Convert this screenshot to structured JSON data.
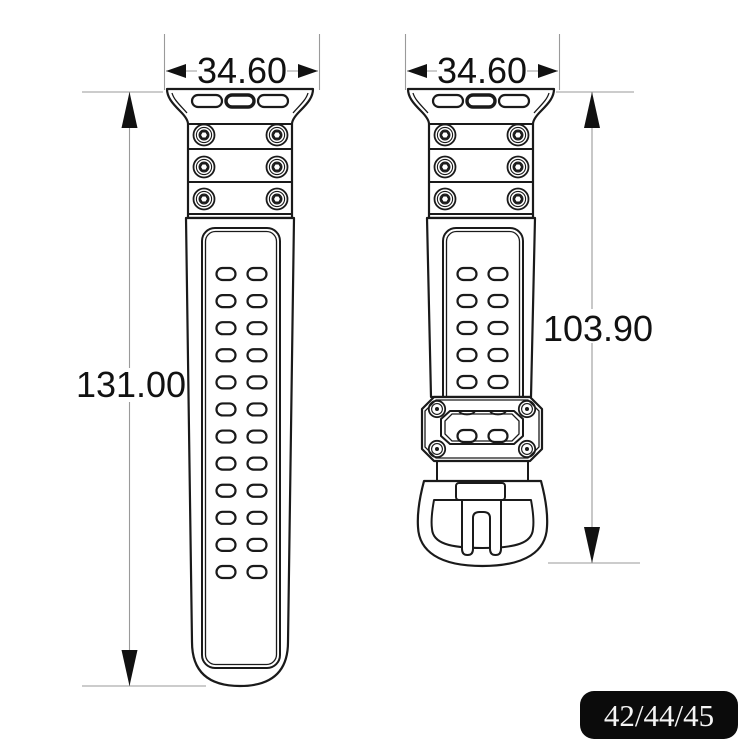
{
  "diagram": {
    "left_strap": {
      "width_label": "34.60",
      "length_label": "131.00",
      "hole_rows": 12,
      "hole_columns": 2,
      "screw_count": 6
    },
    "right_strap": {
      "width_label": "34.60",
      "length_label": "103.90",
      "hole_rows": 5,
      "hole_columns": 2,
      "screw_count": 6,
      "keeper_screw_count": 4
    },
    "size_badge": {
      "label": "42/44/45"
    },
    "colors": {
      "line": "#1a1a1a",
      "dimension_line": "#9a9a9a",
      "text": "#111111",
      "badge_background": "#0b0b0b",
      "badge_text": "#f5f5f5",
      "background": "#ffffff"
    }
  }
}
